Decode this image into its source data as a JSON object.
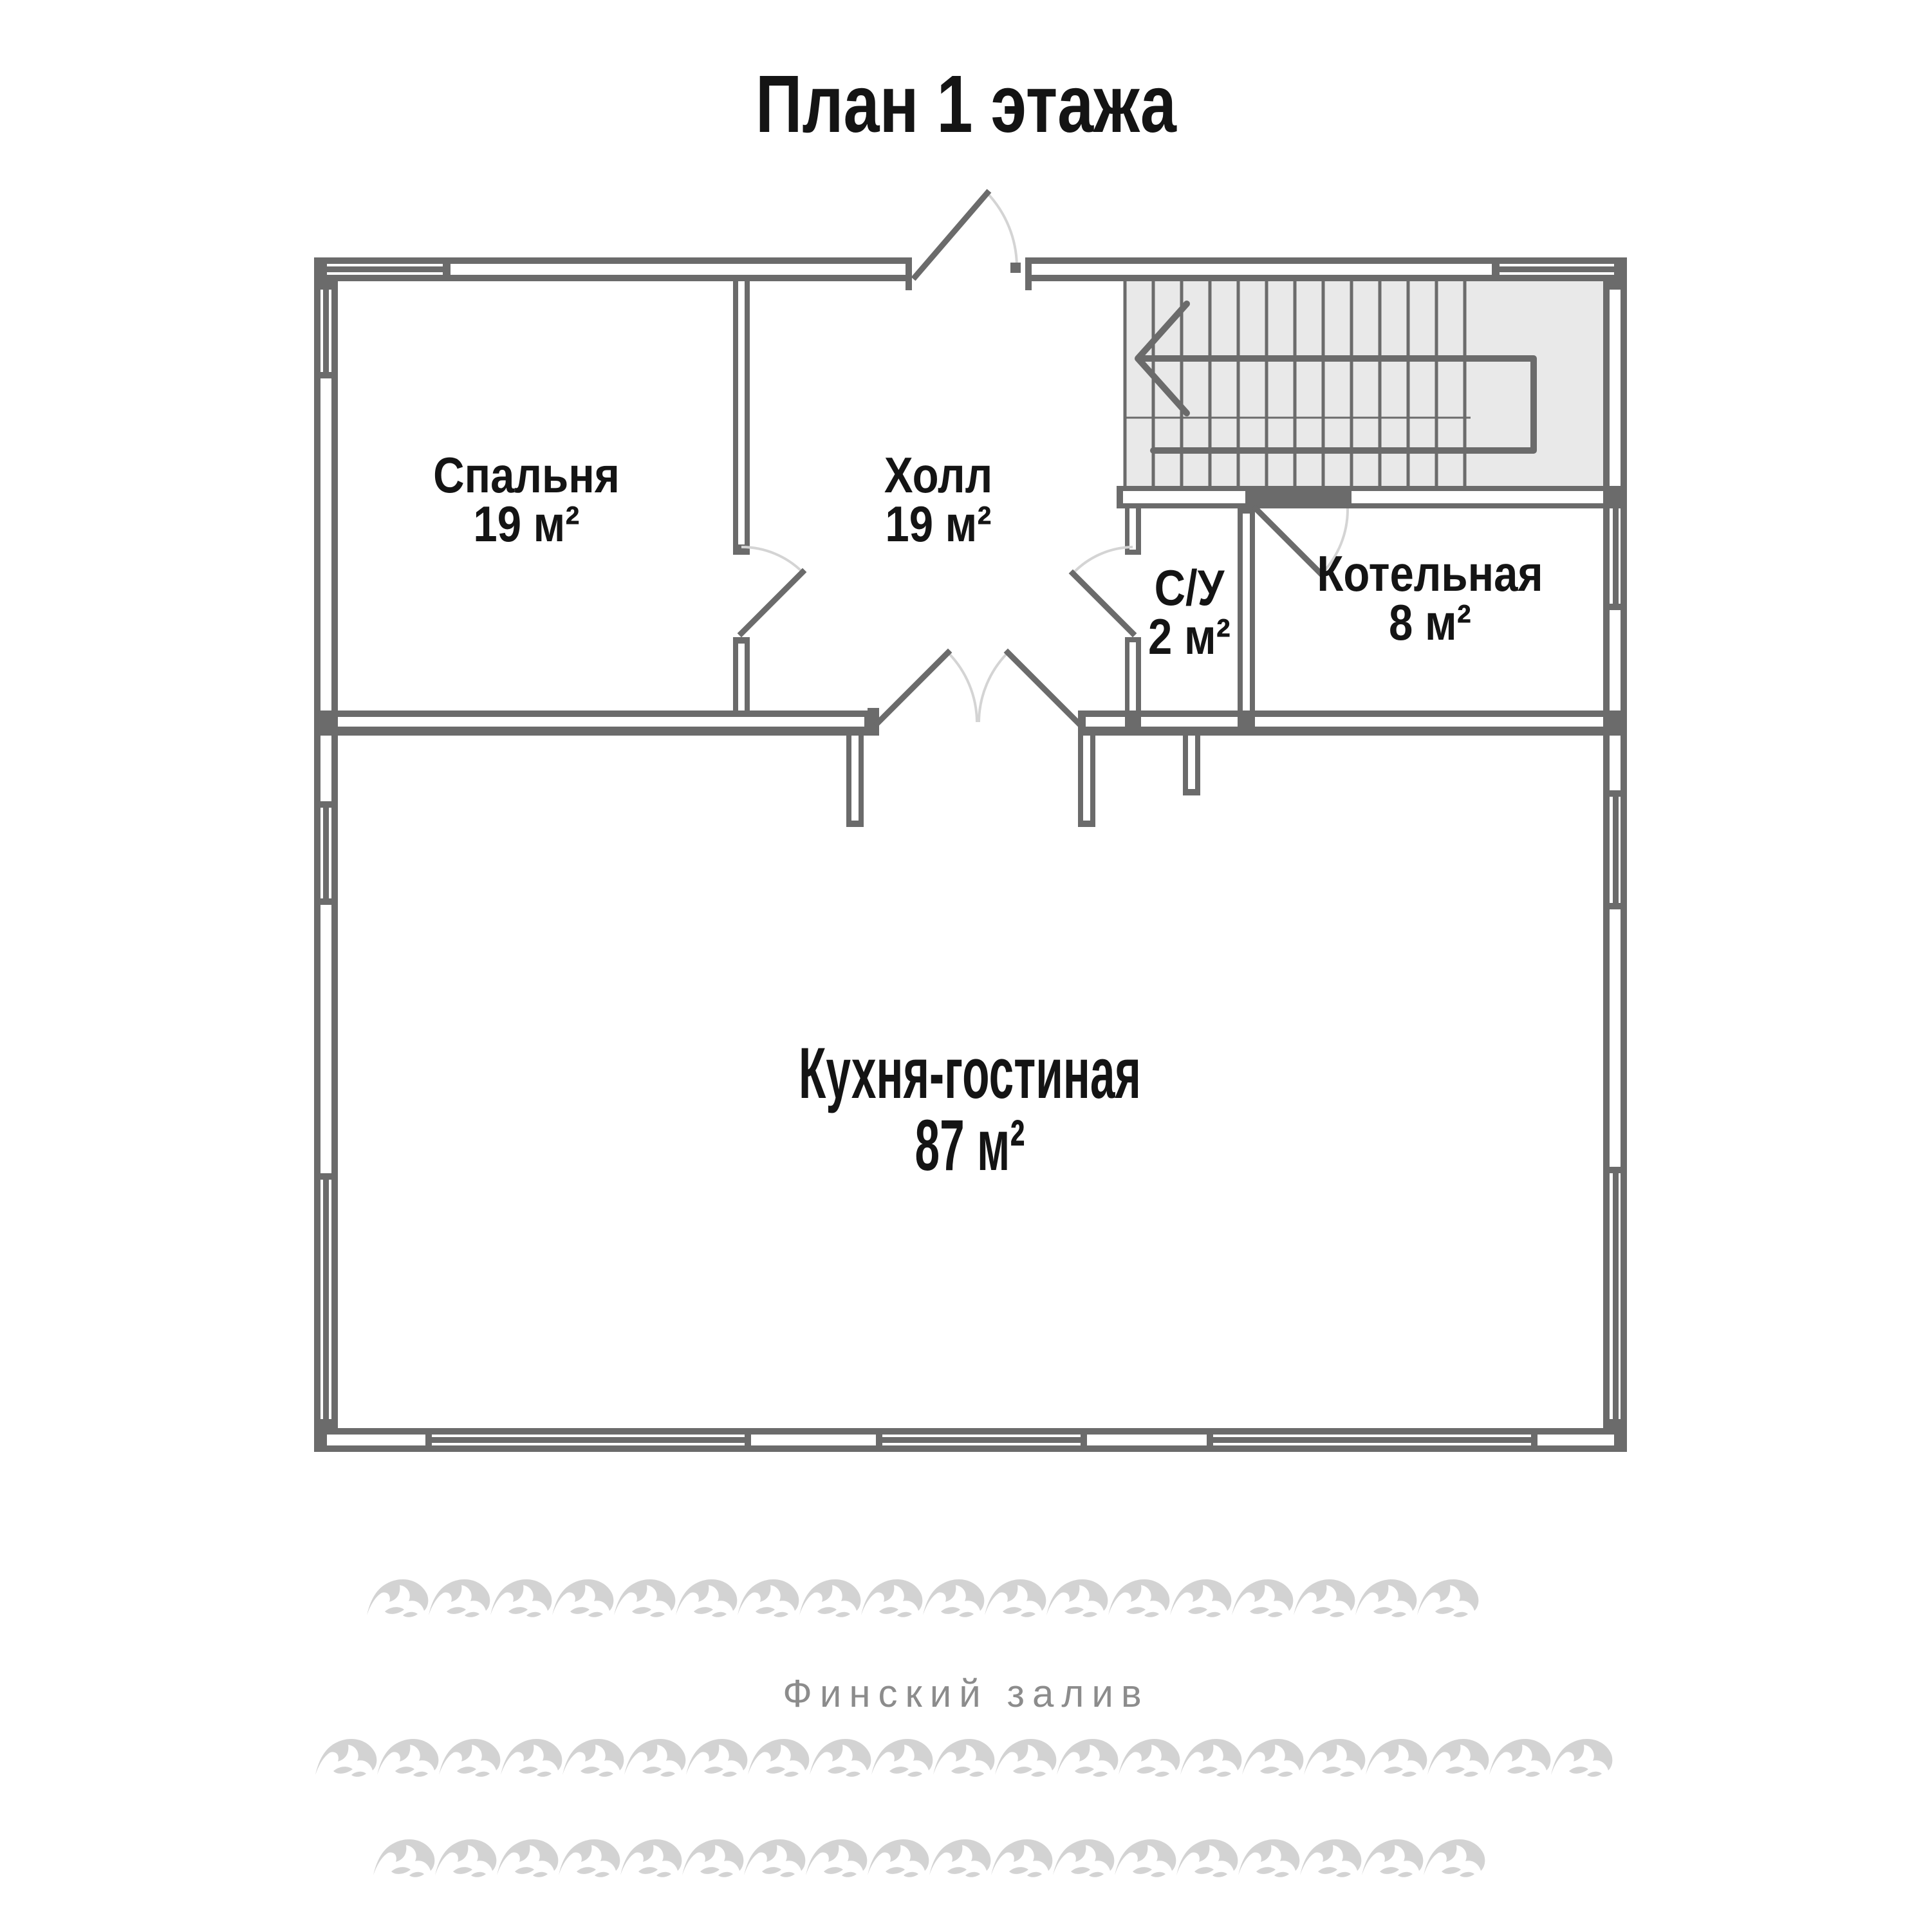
{
  "title": "План 1 этажа",
  "rooms": {
    "bedroom": {
      "name": "Спальня",
      "area": "19 м²"
    },
    "hall": {
      "name": "Холл",
      "area": "19 м²"
    },
    "wc": {
      "name": "С/У",
      "area": "2 м²"
    },
    "boiler": {
      "name": "Котельная",
      "area": "8 м²"
    },
    "kitchen": {
      "name": "Кухня-гостиная",
      "area": "87 м²"
    }
  },
  "water": {
    "label": "Финский залив"
  },
  "stairs": {
    "direction": "up-to-left-arrow"
  },
  "colors": {
    "wall": "#6b6b6b",
    "stairs_fill": "#e9e9e9",
    "door_arc": "#d4d4d4",
    "wave": "#d3d3d3",
    "water_text": "#8c8c8c",
    "label_text": "#141414"
  }
}
